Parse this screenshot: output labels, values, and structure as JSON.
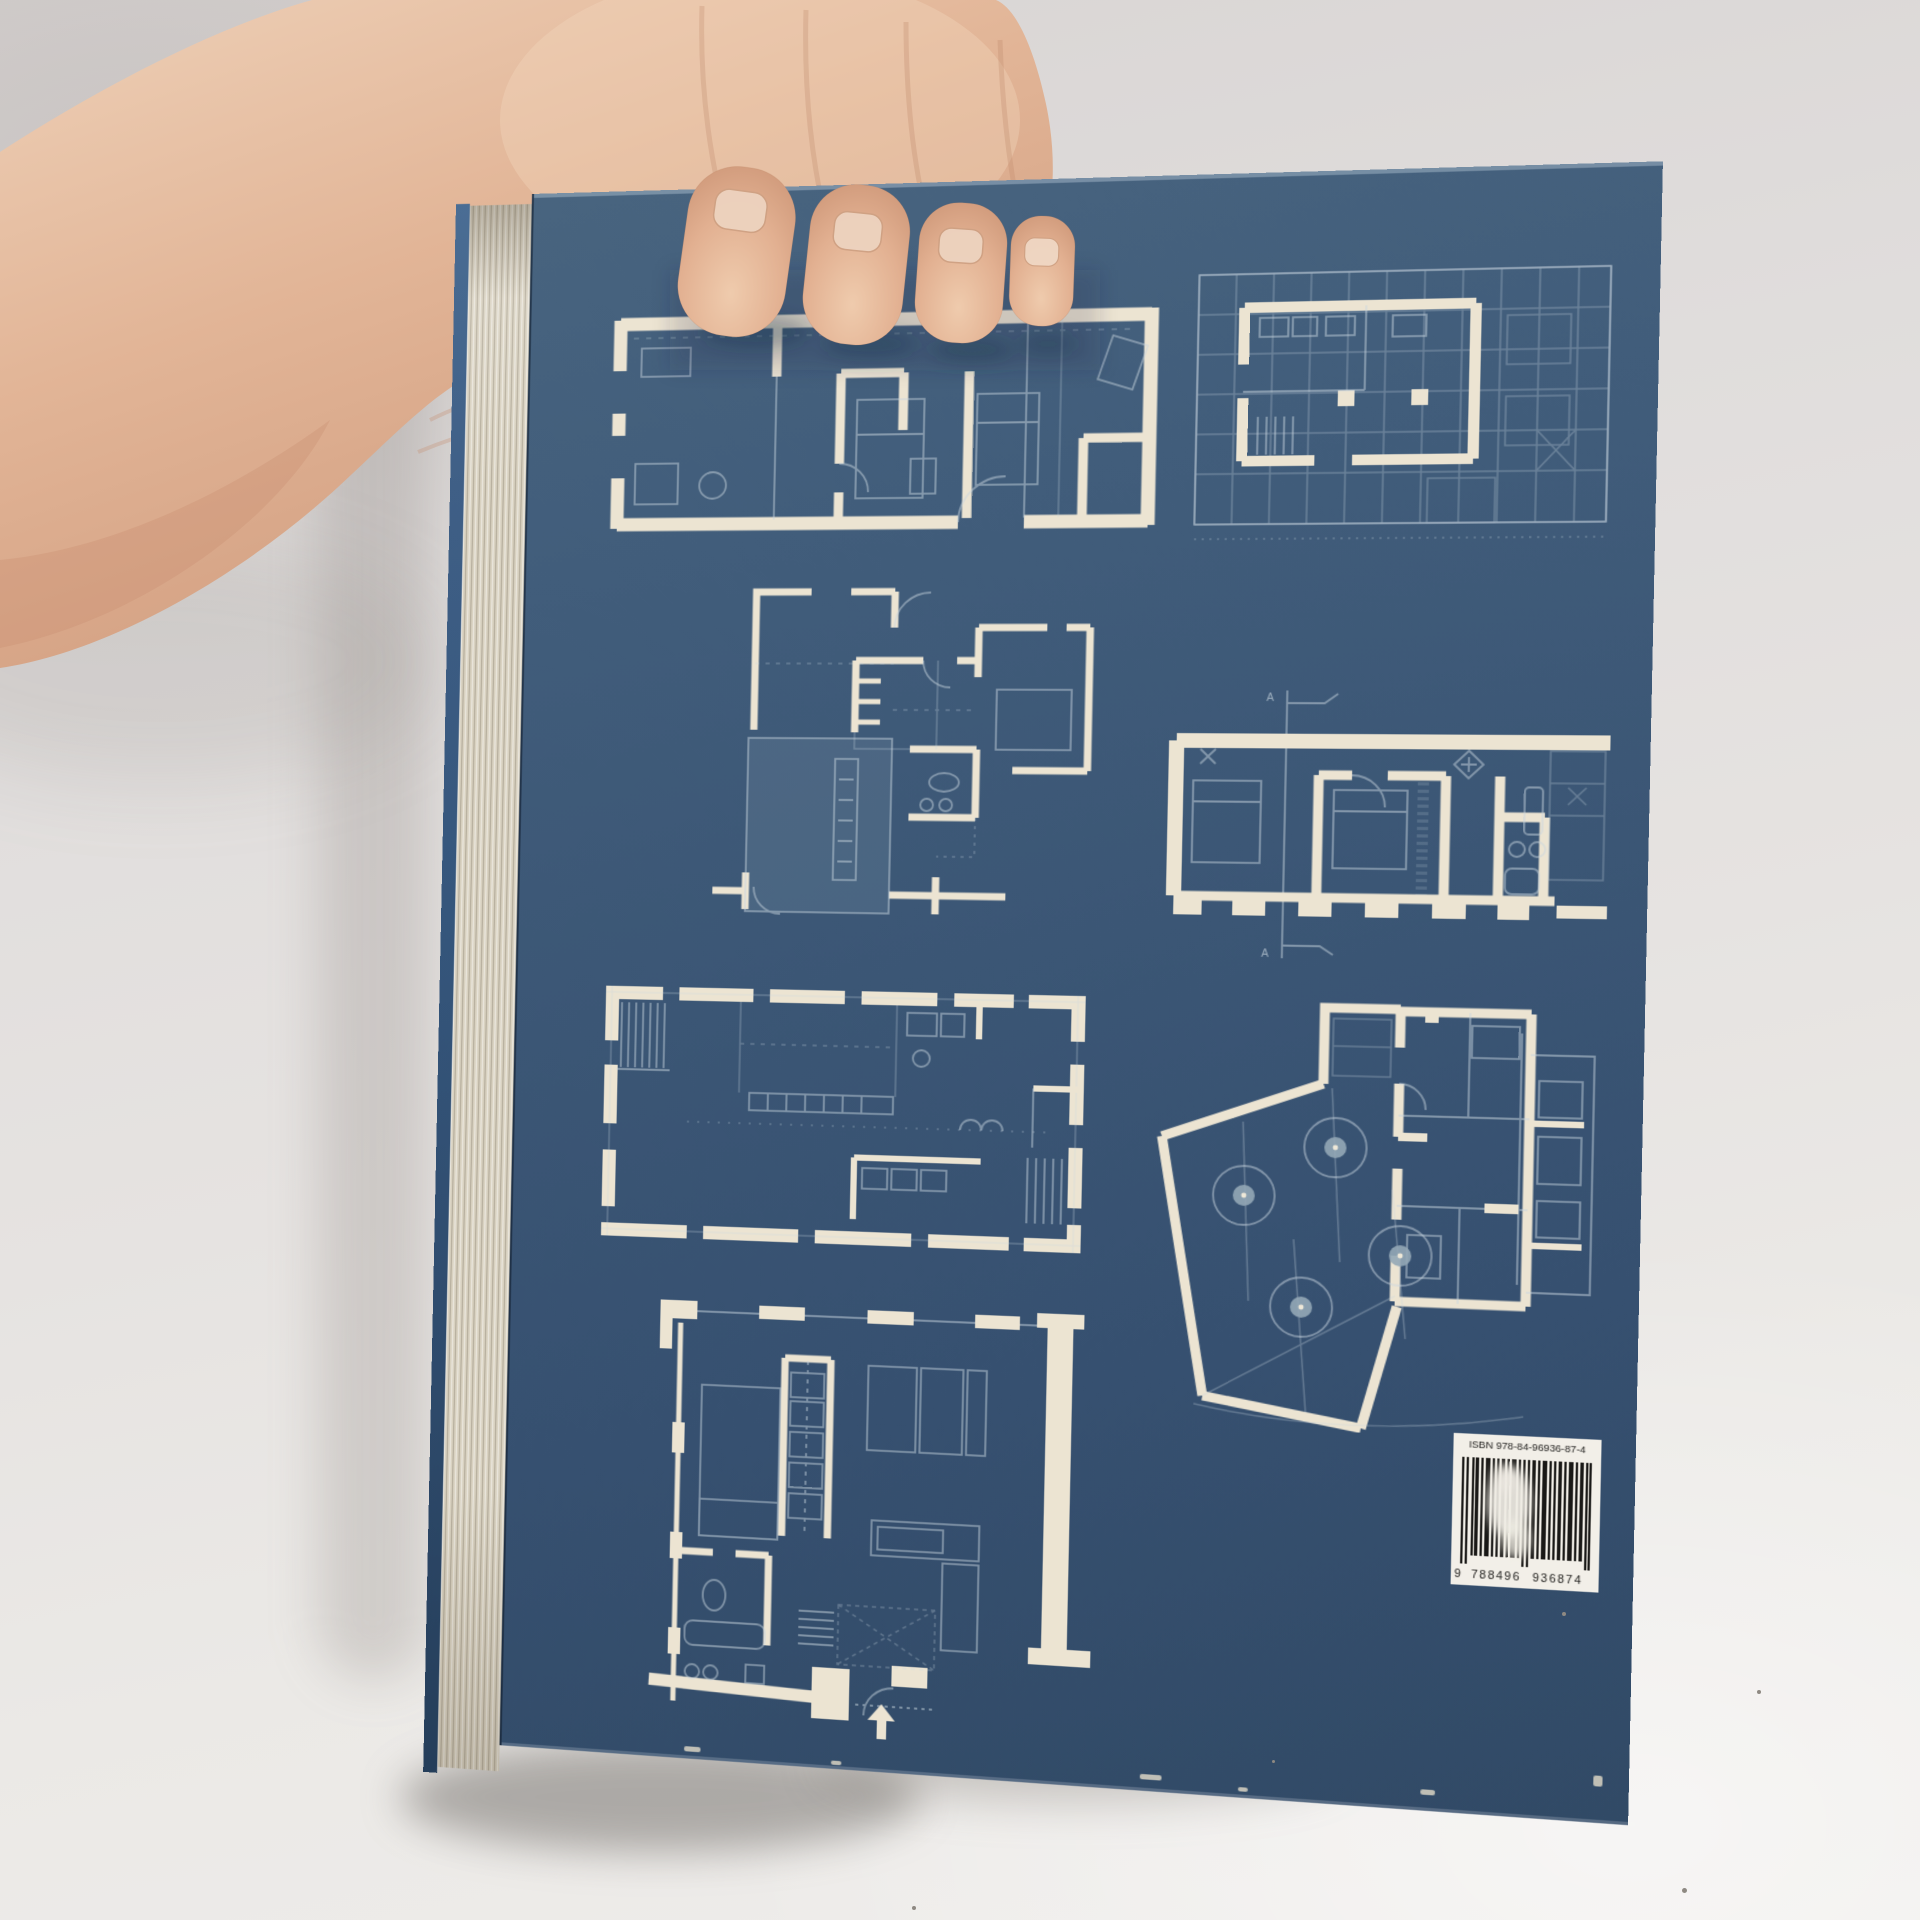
{
  "scene": {
    "type": "photograph",
    "subject": "hand holding an architecture book, back cover with blueprint floor plans",
    "background_wall_color": "#e2dfde",
    "floor_color": "#edebe8",
    "skin_color": "#e0b294"
  },
  "book": {
    "cover_color": "#3b5675",
    "plan_wall_color": "#ece4d2",
    "plan_line_color": "#c9d6df",
    "pages_edge_color": "#d9d2c1",
    "spine_edge_color": "#35567c",
    "section_label": "A",
    "floor_plans": [
      {
        "name": "long-apartment-plan",
        "description": "elongated rectangular apartment floor plan with thick outer walls"
      },
      {
        "name": "building-unit-plan",
        "description": "apartment unit highlighted inside faint building grid"
      },
      {
        "name": "offset-house-plan",
        "description": "irregular house plan with offset rooms and shaded lower room"
      },
      {
        "name": "linear-apartment-plan",
        "description": "wide apartment plan with pillared lower wall and section line A-A"
      },
      {
        "name": "open-loft-plan",
        "description": "large open loft plan with segmented perimeter walls"
      },
      {
        "name": "courtyard-plan",
        "description": "angled courtyard with four trees adjoining a rectangular house"
      },
      {
        "name": "studio-plan",
        "description": "square studio apartment plan with entry arrow"
      }
    ],
    "barcode": {
      "isbn_label": "ISBN 978-84-96936-87-4",
      "digit_prefix": "9",
      "digits_group_1": "788496",
      "digits_group_2": "936874"
    }
  }
}
